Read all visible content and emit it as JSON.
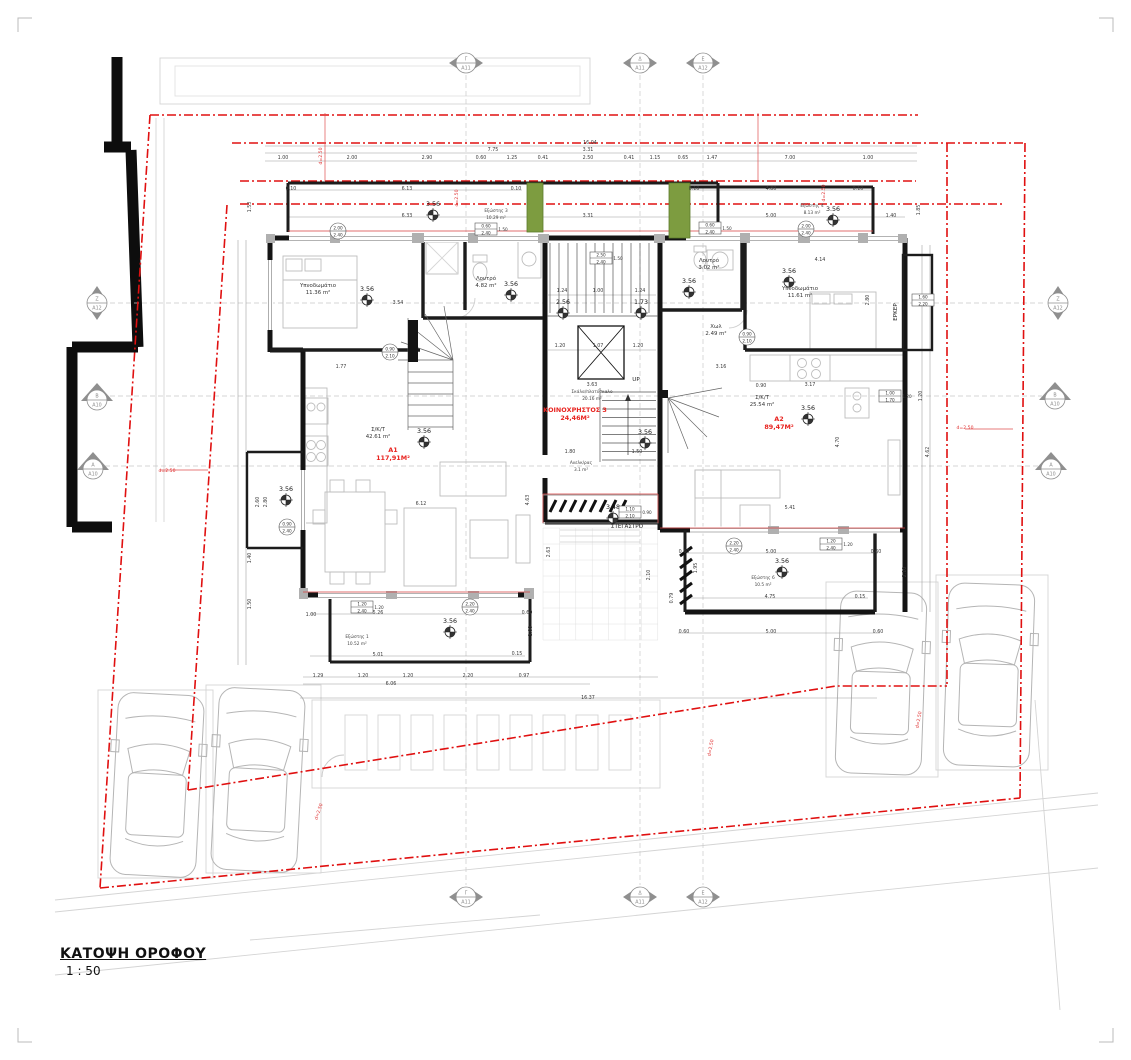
{
  "title": {
    "name": "ΚΑΤΟΨΗ ΟΡΟΦΟΥ",
    "scale": "1 : 50"
  },
  "colors": {
    "boundary_red": "#e01010",
    "apartment_label_red": "#e8231f",
    "wall_black": "#141414",
    "planter_green": "#7d9c40",
    "site_gray": "#d4d4d4"
  },
  "plan": {
    "apartments": [
      {
        "id": "A1",
        "area_label": "117,91Μ²",
        "x": 393,
        "y": 452
      },
      {
        "id": "A2",
        "area_label": "89,47Μ²",
        "x": 779,
        "y": 421
      },
      {
        "id": "ΚΟΙΝΟΧΡΗΣΤΟΣ 3",
        "area_label": "24,46Μ²",
        "x": 575,
        "y": 412
      }
    ],
    "rooms": [
      {
        "name": "Υπνοδωμάτιο",
        "area": "11.36 m²",
        "x": 318,
        "y": 287
      },
      {
        "name": "Λουτρό",
        "area": "4.82 m²",
        "x": 486,
        "y": 280
      },
      {
        "name": "Λουτρό",
        "area": "3.02 m²",
        "x": 709,
        "y": 262
      },
      {
        "name": "Υπνοδωμάτιο",
        "area": "11.61 m²",
        "x": 800,
        "y": 290
      },
      {
        "name": "Χωλ",
        "area": "2.49 m²",
        "x": 716,
        "y": 328
      },
      {
        "name": "Σ/Κ/Τ",
        "area": "42.61 m²",
        "x": 378,
        "y": 431
      },
      {
        "name": "Σ/Κ/Τ",
        "area": "25.54 m²",
        "x": 762,
        "y": 399
      },
      {
        "name": "Σκάλα/πλατύσκαλο",
        "area": "20.16 m²",
        "x": 592,
        "y": 393,
        "small": true
      },
      {
        "name": "Ανελκ/ρας",
        "area": "3.1 m²",
        "x": 581,
        "y": 464,
        "small": true
      },
      {
        "name": "Εξώστης 3",
        "area": "10.29 m²",
        "x": 496,
        "y": 212,
        "small": true
      },
      {
        "name": "Εξώστης 4",
        "area": "8.13 m²",
        "x": 812,
        "y": 207,
        "small": true
      },
      {
        "name": "Εξώστης 1",
        "area": "10.52 m²",
        "x": 357,
        "y": 638,
        "small": true
      },
      {
        "name": "Εξώστης 6",
        "area": "10.5 m²",
        "x": 763,
        "y": 579,
        "small": true
      }
    ],
    "misc_labels": [
      {
        "t": "ΕΡΚΕΡ",
        "x": 897,
        "y": 312,
        "r": -90
      },
      {
        "t": "ΣΤΕΓΑΣΤΡΟ",
        "x": 627,
        "y": 528
      },
      {
        "t": "UP",
        "x": 636,
        "y": 381
      }
    ],
    "levels": [
      {
        "v": "3.56",
        "x": 433,
        "y": 206
      },
      {
        "v": "3.56",
        "x": 833,
        "y": 211
      },
      {
        "v": "3.56",
        "x": 367,
        "y": 291
      },
      {
        "v": "3.56",
        "x": 511,
        "y": 286
      },
      {
        "v": "2.56",
        "x": 563,
        "y": 304
      },
      {
        "v": "1.73",
        "x": 641,
        "y": 304
      },
      {
        "v": "3.56",
        "x": 689,
        "y": 283
      },
      {
        "v": "3.56",
        "x": 789,
        "y": 273
      },
      {
        "v": "3.56",
        "x": 424,
        "y": 433
      },
      {
        "v": "3.56",
        "x": 808,
        "y": 410
      },
      {
        "v": "3.56",
        "x": 645,
        "y": 434
      },
      {
        "v": "3.56",
        "x": 286,
        "y": 491
      },
      {
        "v": "3.48",
        "x": 613,
        "y": 509
      },
      {
        "v": "3.56",
        "x": 450,
        "y": 623
      },
      {
        "v": "3.56",
        "x": 782,
        "y": 563
      }
    ],
    "grid_markers": [
      {
        "l": "Γ",
        "s": "A11",
        "x": 466,
        "y": 63,
        "t": "h"
      },
      {
        "l": "Δ",
        "s": "A11",
        "x": 640,
        "y": 63,
        "t": "h"
      },
      {
        "l": "Ε",
        "s": "A12",
        "x": 703,
        "y": 63,
        "t": "h"
      },
      {
        "l": "Γ",
        "s": "A11",
        "x": 466,
        "y": 897,
        "t": "h"
      },
      {
        "l": "Δ",
        "s": "A11",
        "x": 640,
        "y": 897,
        "t": "h"
      },
      {
        "l": "Ε",
        "s": "A12",
        "x": 703,
        "y": 897,
        "t": "h"
      },
      {
        "l": "Ζ",
        "s": "A12",
        "x": 97,
        "y": 303,
        "t": "v"
      },
      {
        "l": "Β",
        "s": "A10",
        "x": 97,
        "y": 397,
        "t": "tri"
      },
      {
        "l": "Α",
        "s": "A10",
        "x": 93,
        "y": 466,
        "t": "tri"
      },
      {
        "l": "Ζ",
        "s": "A12",
        "x": 1058,
        "y": 303,
        "t": "v"
      },
      {
        "l": "Β",
        "s": "A10",
        "x": 1055,
        "y": 396,
        "t": "tri"
      },
      {
        "l": "Α",
        "s": "A10",
        "x": 1051,
        "y": 466,
        "t": "tri"
      }
    ],
    "red_notes": [
      {
        "t": "d=2.50",
        "x": 167,
        "y": 472
      },
      {
        "t": "d=2.50",
        "x": 965,
        "y": 429
      },
      {
        "t": "d=2.50",
        "x": 322,
        "y": 156,
        "r": -90
      },
      {
        "t": "d=2.50",
        "x": 458,
        "y": 198,
        "r": -90
      },
      {
        "t": "d=2.50",
        "x": 825,
        "y": 193,
        "r": -90
      },
      {
        "t": "d=2.50",
        "x": 920,
        "y": 720,
        "r": -80
      },
      {
        "t": "d=2.50",
        "x": 320,
        "y": 812,
        "r": -72
      },
      {
        "t": "d=2.50",
        "x": 712,
        "y": 748,
        "r": -80
      }
    ],
    "window_tags": [
      {
        "sh": "c",
        "a": "2.00",
        "b": "2.40",
        "x": 338,
        "y": 231
      },
      {
        "sh": "b",
        "a": "0.60",
        "b": "2.40",
        "s": "1.50",
        "x": 486,
        "y": 229
      },
      {
        "sh": "b",
        "a": "0.60",
        "b": "2.40",
        "s": "1.50",
        "x": 710,
        "y": 228
      },
      {
        "sh": "c",
        "a": "2.00",
        "b": "2.40",
        "x": 806,
        "y": 229
      },
      {
        "sh": "b",
        "a": "2.50",
        "b": "2.40",
        "s": "1.50",
        "x": 601,
        "y": 258
      },
      {
        "sh": "c",
        "a": "0.90",
        "b": "2.10",
        "x": 390,
        "y": 352
      },
      {
        "sh": "c",
        "a": "0.90",
        "b": "2.10",
        "x": 747,
        "y": 337
      },
      {
        "sh": "c",
        "a": "0.90",
        "b": "2.40",
        "x": 287,
        "y": 527
      },
      {
        "sh": "b",
        "a": "1.60",
        "b": "2.20",
        "x": 923,
        "y": 300
      },
      {
        "sh": "b",
        "a": "1.00",
        "b": "1.70",
        "s": "1.20",
        "x": 890,
        "y": 396
      },
      {
        "sh": "b",
        "a": "1.20",
        "b": "2.40",
        "s": "1.20",
        "x": 362,
        "y": 607
      },
      {
        "sh": "c",
        "a": "2.20",
        "b": "2.40",
        "x": 470,
        "y": 607
      },
      {
        "sh": "b",
        "a": "1.10",
        "b": "2.10",
        "s": "0.90",
        "x": 630,
        "y": 512
      },
      {
        "sh": "c",
        "a": "2.20",
        "b": "2.40",
        "x": 734,
        "y": 546
      },
      {
        "sh": "b",
        "a": "1.20",
        "b": "2.40",
        "s": "1.20",
        "x": 831,
        "y": 544
      }
    ],
    "dimensions": [
      {
        "t": "16.04",
        "x": 590,
        "y": 144
      },
      {
        "t": "7.75",
        "x": 493,
        "y": 151
      },
      {
        "t": "3.31",
        "x": 588,
        "y": 151
      },
      {
        "t": "1.00",
        "x": 283,
        "y": 159
      },
      {
        "t": "2.00",
        "x": 352,
        "y": 159
      },
      {
        "t": "2.90",
        "x": 427,
        "y": 159
      },
      {
        "t": "0.60",
        "x": 481,
        "y": 159
      },
      {
        "t": "1.25",
        "x": 512,
        "y": 159
      },
      {
        "t": "0.41",
        "x": 543,
        "y": 159
      },
      {
        "t": "2.50",
        "x": 588,
        "y": 159
      },
      {
        "t": "0.41",
        "x": 629,
        "y": 159
      },
      {
        "t": "1.15",
        "x": 655,
        "y": 159
      },
      {
        "t": "0.65",
        "x": 683,
        "y": 159
      },
      {
        "t": "1.47",
        "x": 712,
        "y": 159
      },
      {
        "t": "7.00",
        "x": 790,
        "y": 159
      },
      {
        "t": "1.00",
        "x": 868,
        "y": 159
      },
      {
        "t": "0.10",
        "x": 291,
        "y": 190
      },
      {
        "t": "6.13",
        "x": 407,
        "y": 190
      },
      {
        "t": "0.10",
        "x": 516,
        "y": 190
      },
      {
        "t": "0.10",
        "x": 694,
        "y": 190
      },
      {
        "t": "4.80",
        "x": 771,
        "y": 190
      },
      {
        "t": "0.10",
        "x": 858,
        "y": 190
      },
      {
        "t": "6.33",
        "x": 407,
        "y": 217
      },
      {
        "t": "3.31",
        "x": 588,
        "y": 217
      },
      {
        "t": "5.00",
        "x": 771,
        "y": 217
      },
      {
        "t": "1.40",
        "x": 891,
        "y": 217
      },
      {
        "t": "1.53",
        "x": 251,
        "y": 207,
        "r": -90
      },
      {
        "t": "1.85",
        "x": 920,
        "y": 210,
        "r": -90
      },
      {
        "t": "3.54",
        "x": 398,
        "y": 304
      },
      {
        "t": "4.14",
        "x": 820,
        "y": 261
      },
      {
        "t": "2.80",
        "x": 869,
        "y": 300,
        "r": -90
      },
      {
        "t": "1.24",
        "x": 562,
        "y": 292
      },
      {
        "t": "1.00",
        "x": 598,
        "y": 292
      },
      {
        "t": "1.24",
        "x": 640,
        "y": 292
      },
      {
        "t": "1.20",
        "x": 560,
        "y": 347
      },
      {
        "t": "1.07",
        "x": 598,
        "y": 347
      },
      {
        "t": "1.20",
        "x": 638,
        "y": 347
      },
      {
        "t": "1.77",
        "x": 341,
        "y": 368
      },
      {
        "t": "3.63",
        "x": 592,
        "y": 386
      },
      {
        "t": "3.16",
        "x": 721,
        "y": 368
      },
      {
        "t": "0.90",
        "x": 761,
        "y": 387
      },
      {
        "t": "3.17",
        "x": 810,
        "y": 386
      },
      {
        "t": "6.12",
        "x": 421,
        "y": 505
      },
      {
        "t": "4.63",
        "x": 529,
        "y": 500,
        "r": -90
      },
      {
        "t": "2.60",
        "x": 259,
        "y": 502,
        "r": -90
      },
      {
        "t": "2.80",
        "x": 267,
        "y": 502,
        "r": -90
      },
      {
        "t": "5.41",
        "x": 790,
        "y": 509
      },
      {
        "t": "4.70",
        "x": 839,
        "y": 442,
        "r": -90
      },
      {
        "t": "1.80",
        "x": 570,
        "y": 453
      },
      {
        "t": "1.50",
        "x": 637,
        "y": 453
      },
      {
        "t": "2.63",
        "x": 550,
        "y": 552,
        "r": -90
      },
      {
        "t": "2.10",
        "x": 650,
        "y": 575,
        "r": -90
      },
      {
        "t": "1.40",
        "x": 251,
        "y": 558,
        "r": -90
      },
      {
        "t": "1.50",
        "x": 251,
        "y": 604,
        "r": -90
      },
      {
        "t": "5.26",
        "x": 378,
        "y": 614
      },
      {
        "t": "0.60",
        "x": 527,
        "y": 614
      },
      {
        "t": "1.00",
        "x": 311,
        "y": 616
      },
      {
        "t": "5.01",
        "x": 378,
        "y": 656
      },
      {
        "t": "0.15",
        "x": 517,
        "y": 655
      },
      {
        "t": "1.00",
        "x": 532,
        "y": 631,
        "r": -90
      },
      {
        "t": "1.29",
        "x": 318,
        "y": 677
      },
      {
        "t": "1.20",
        "x": 363,
        "y": 677
      },
      {
        "t": "1.20",
        "x": 408,
        "y": 677
      },
      {
        "t": "2.20",
        "x": 468,
        "y": 677
      },
      {
        "t": "0.97",
        "x": 524,
        "y": 677
      },
      {
        "t": "6.06",
        "x": 391,
        "y": 685
      },
      {
        "t": "16.37",
        "x": 588,
        "y": 699
      },
      {
        "t": "0.60",
        "x": 684,
        "y": 553
      },
      {
        "t": "5.00",
        "x": 771,
        "y": 553
      },
      {
        "t": "0.60",
        "x": 876,
        "y": 553
      },
      {
        "t": "1.95",
        "x": 697,
        "y": 568,
        "r": -90
      },
      {
        "t": "0.79",
        "x": 673,
        "y": 598,
        "r": -90
      },
      {
        "t": "4.75",
        "x": 770,
        "y": 598
      },
      {
        "t": "0.15",
        "x": 860,
        "y": 598
      },
      {
        "t": "5.00",
        "x": 771,
        "y": 633
      },
      {
        "t": "0.60",
        "x": 684,
        "y": 633
      },
      {
        "t": "0.60",
        "x": 878,
        "y": 633
      },
      {
        "t": "2.10",
        "x": 906,
        "y": 572,
        "r": -90
      },
      {
        "t": "4.62",
        "x": 929,
        "y": 452,
        "r": -90
      },
      {
        "t": "1.20",
        "x": 922,
        "y": 396,
        "r": -90
      }
    ]
  }
}
